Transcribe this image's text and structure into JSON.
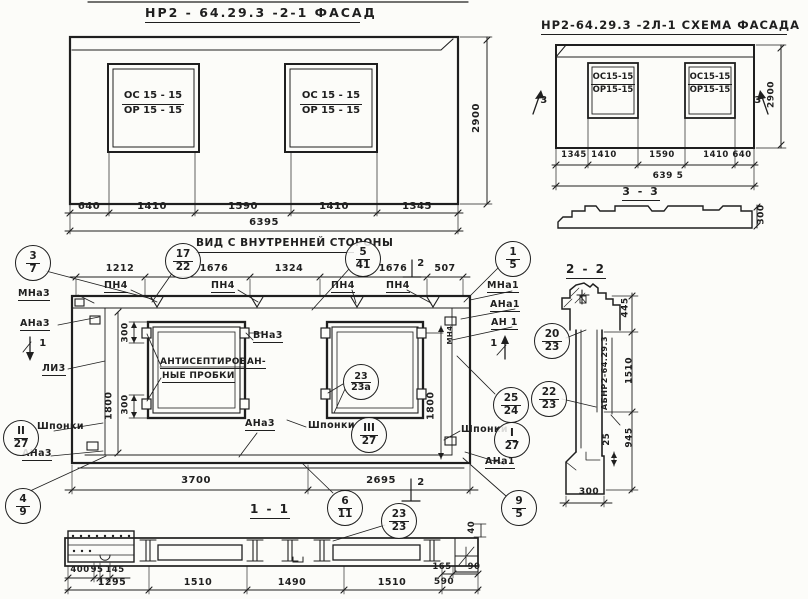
{
  "facade": {
    "title": "НР2 - 64.29.3 -2-1  ФАСАД",
    "window": {
      "top": "ОС 15 - 15",
      "bottom": "ОР 15 - 15"
    },
    "dims": [
      "640",
      "1410",
      "1590",
      "1410",
      "1345"
    ],
    "total": "6395",
    "height": "2900"
  },
  "schema": {
    "title": "НР2-64.29.3  -2Л-1 СХЕМА ФАСАДА",
    "window": {
      "top": "ОС15-15",
      "bottom": "ОР15-15"
    },
    "dims": [
      "1345",
      "1410",
      "1590",
      "1410",
      "640"
    ],
    "total": "639 5",
    "height": "2900",
    "flag": "3",
    "section": {
      "title": "3 - 3",
      "height": "300"
    }
  },
  "interior": {
    "title": "ВИД С ВНУТРЕННЕЙ СТОРОНЫ",
    "dims_top": [
      "1212",
      "1676",
      "1324",
      "1676",
      "507"
    ],
    "pn4": "ПН4",
    "note": [
      "АНТИСЕПТИРОВАН-",
      "НЫЕ ПРОБКИ"
    ],
    "dim_300": "300",
    "dim_1800": "1800",
    "dims_bottom": [
      "3700",
      "2695"
    ],
    "marks": {
      "mna3": "МНа3",
      "ana3": "АНа3",
      "li3": "ЛИ3",
      "vna3": "ВНа3",
      "mna1": "МНа1",
      "ana1": "АНа1",
      "an1": "АН 1",
      "mn4": "МН4",
      "shponki": "Шпонки"
    },
    "flags": {
      "one": "1",
      "two": "2"
    }
  },
  "callouts": {
    "c37": {
      "top": "3",
      "bot": "7"
    },
    "c1722": {
      "top": "17",
      "bot": "22"
    },
    "c541": {
      "top": "5",
      "bot": "41"
    },
    "c15": {
      "top": "1",
      "bot": "5"
    },
    "c2323a": {
      "top": "23",
      "bot": "23а"
    },
    "c2023": {
      "top": "20",
      "bot": "23"
    },
    "c2223": {
      "top": "22",
      "bot": "23"
    },
    "c2524": {
      "top": "25",
      "bot": "24"
    },
    "cI27": {
      "top": "I",
      "bot": "27"
    },
    "cII27": {
      "top": "II",
      "bot": "27"
    },
    "cIII27": {
      "top": "III",
      "bot": "27"
    },
    "c49": {
      "top": "4",
      "bot": "9"
    },
    "c611": {
      "top": "6",
      "bot": "11"
    },
    "c2323": {
      "top": "23",
      "bot": "23"
    },
    "c95": {
      "top": "9",
      "bot": "5"
    }
  },
  "section22": {
    "title": "2 - 2",
    "stamp": "АБНР2-64.29.3",
    "d445": "445",
    "d1510": "1510",
    "d945": "945",
    "d25": "25",
    "d300": "300"
  },
  "section11": {
    "title": "1 - 1",
    "d400": "400",
    "d95": "95",
    "d145": "145",
    "d1295": "1295",
    "d1510a": "1510",
    "d1490": "1490",
    "d1510b": "1510",
    "d165": "165",
    "d590": "590",
    "d90": "90",
    "d40": "40"
  }
}
